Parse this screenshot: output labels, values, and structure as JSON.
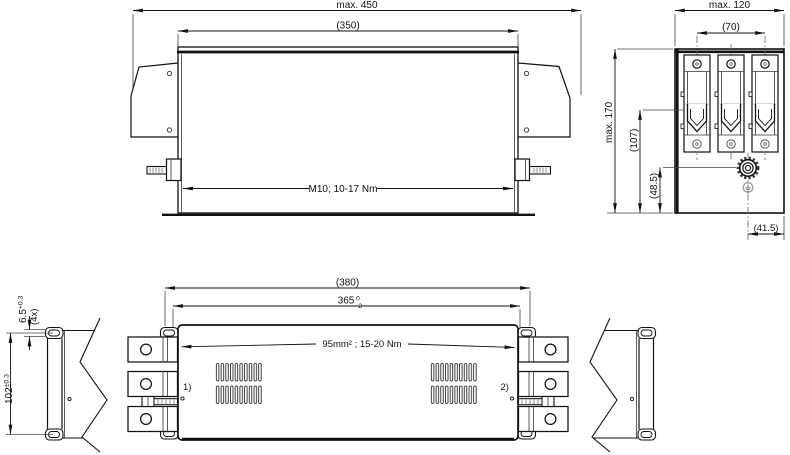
{
  "drawing": {
    "front_view": {
      "dim_overall_width": "max. 450",
      "dim_body_width": "(350)",
      "stud_label": "M10; 10-17 Nm"
    },
    "side_view": {
      "dim_overall_depth": "max. 120",
      "dim_terminal_pitch": "(70)",
      "dim_overall_height": "max. 170",
      "dim_terminal_height": "(107)",
      "dim_stud_height": "(48.5)",
      "dim_stud_offset": "(41.5)"
    },
    "top_view": {
      "dim_overall_length": "(380)",
      "dim_mounting_length": "365",
      "dim_mounting_tol_upper": "0",
      "dim_mounting_tol_lower": "-2",
      "terminal_label": "95mm² ; 15-20 Nm",
      "ref_left": "1)",
      "ref_right": "2)",
      "dim_slot_width": "6.5",
      "dim_slot_width_tol": "+0.3",
      "dim_slot_count": "(4x)",
      "dim_slot_pitch": "102",
      "dim_slot_pitch_tol": "±0.3"
    }
  }
}
